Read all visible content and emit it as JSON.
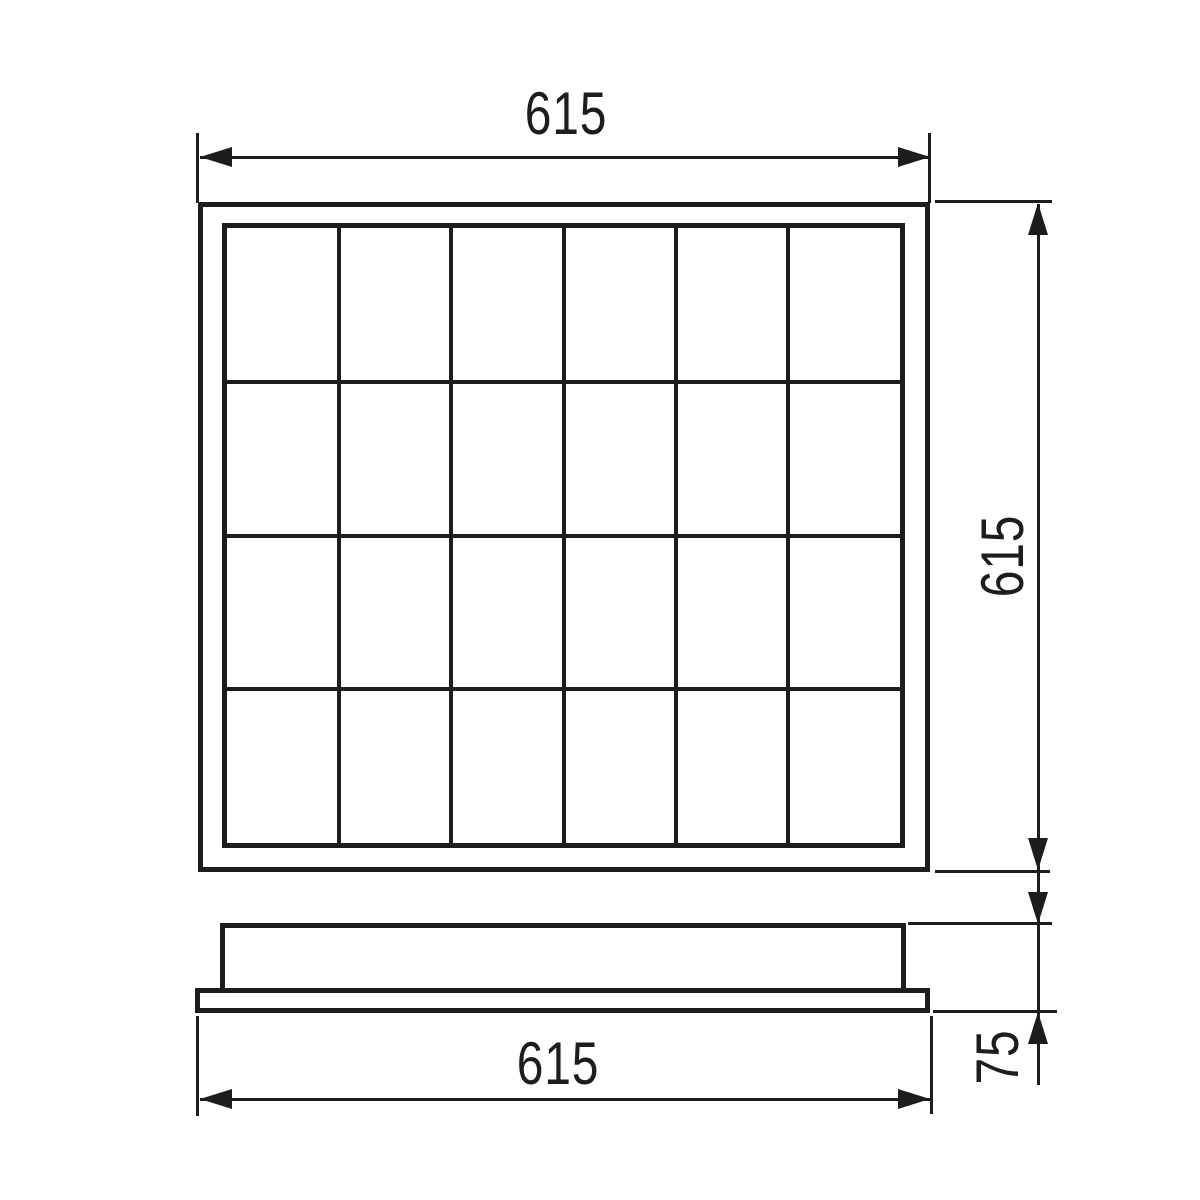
{
  "colors": {
    "line": "#1d1d1b",
    "background": "#ffffff"
  },
  "front_view": {
    "grid_columns": 6,
    "grid_rows": 4
  },
  "dimensions": {
    "top_width": "615",
    "right_height": "615",
    "bottom_width": "615",
    "profile_height": "75"
  }
}
